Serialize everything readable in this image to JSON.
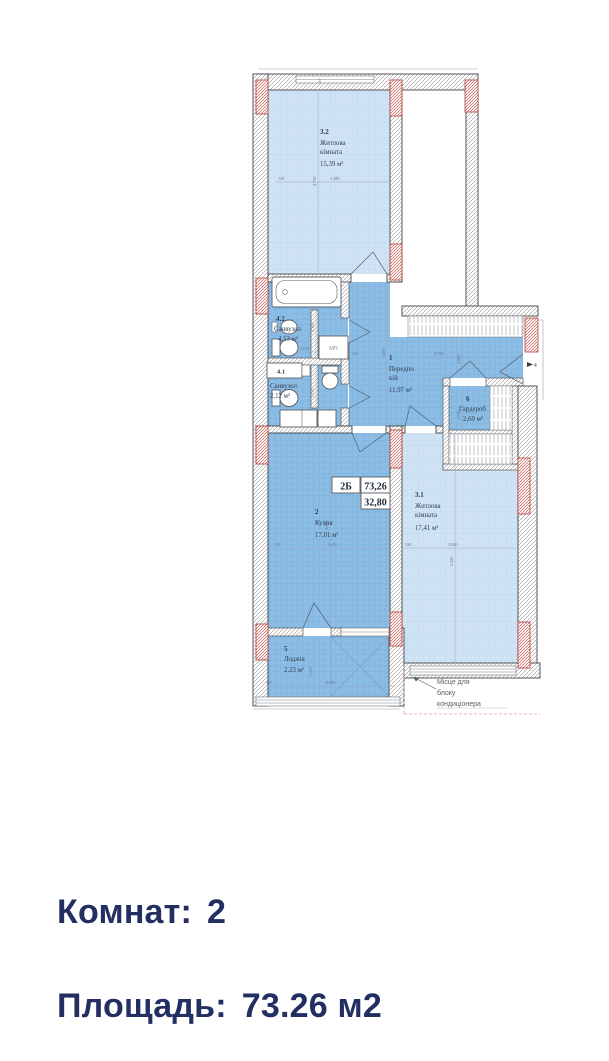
{
  "summary": {
    "rooms_label": "Комнат:",
    "rooms_value": "2",
    "area_label": "Площадь:",
    "area_value": "73.26 м2"
  },
  "plan": {
    "unit": {
      "type": "2Б",
      "total_area": "73,26",
      "living_area": "32,80"
    },
    "rooms": [
      {
        "number": "3.2",
        "name_line1": "Житлова",
        "name_line2": "кімната",
        "area": "15,39 м²"
      },
      {
        "number": "4.2",
        "name_line1": "Санвузол",
        "name_line2": "",
        "area": "4,53 м²"
      },
      {
        "number": "4.1",
        "name_line1": "Санвузол",
        "name_line2": "",
        "area": "2,12 м²"
      },
      {
        "number": "1",
        "name_line1": "Передпо",
        "name_line2": "кій",
        "area": "11,97 м²"
      },
      {
        "number": "6",
        "name_line1": "Гардероб",
        "name_line2": "",
        "area": "2,60 м²"
      },
      {
        "number": "2",
        "name_line1": "Кухня",
        "name_line2": "",
        "area": "17,01 м²"
      },
      {
        "number": "3.1",
        "name_line1": "Житлова",
        "name_line2": "кімната",
        "area": "17,41 м²"
      },
      {
        "number": "5",
        "name_line1": "Лоджія",
        "name_line2": "",
        "area": "2,23 м²"
      }
    ],
    "annotations": {
      "ac_line1": "Місце для",
      "ac_line2": "блоку",
      "ac_line3": "кондиціонера",
      "washing_machine": "МП",
      "entrance_marker": "4"
    },
    "dims": {
      "d120": "120",
      "d410": "410",
      "d250": "250",
      "r32_w": "3.280",
      "r32_h": "4.730",
      "b42_w": "2.010",
      "b42_h": "2.300",
      "b41_h": "1.150",
      "hall_h": "3.800",
      "hall_w": "4.750",
      "hall_d": "1.850",
      "ward_h": "1.650",
      "kit_w": "3.410",
      "kit_h": "3.070",
      "liv_w": "3.050",
      "liv_h": "5.520",
      "log_w": "2.990",
      "log_h": "1.550"
    }
  },
  "colors": {
    "accent_text": "#232e62",
    "room_light": "#cfe3f4",
    "room_medium": "#8cbde5",
    "pier_red": "#c4574e"
  }
}
